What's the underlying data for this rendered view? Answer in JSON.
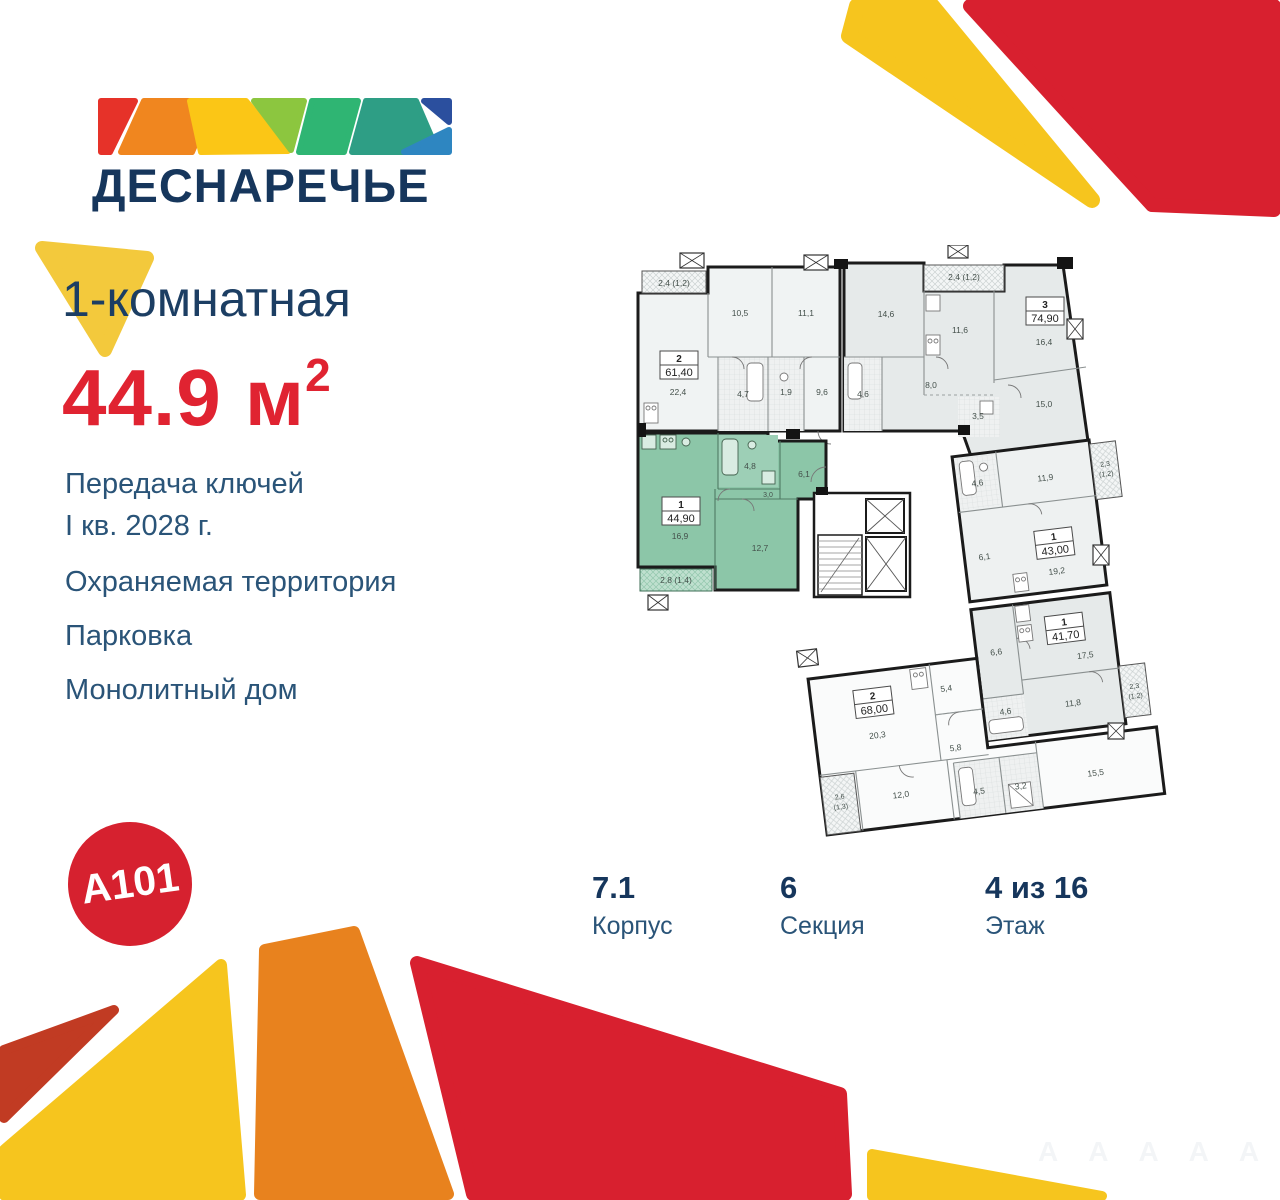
{
  "brand": {
    "logo_text": "ДЕСНАРЕЧЬЕ",
    "developer_logo": "A101"
  },
  "headline": {
    "rooms_type": "1-комнатная",
    "area_value": "44.9",
    "area_unit": " м",
    "area_sup": "2"
  },
  "features": {
    "keys_line1": "Передача ключей",
    "keys_line2": "I кв. 2028 г.",
    "security": "Охраняемая территория",
    "parking": "Парковка",
    "construction": "Монолитный дом"
  },
  "details": {
    "building_value": "7.1",
    "building_label": "Корпус",
    "section_value": "6",
    "section_label": "Секция",
    "floor_value": "4 из 16",
    "floor_label": "Этаж"
  },
  "colors": {
    "accent_red": "#E02331",
    "brand_navy": "#16365C",
    "selected_unit_green": "#8CC6A8",
    "decor_yellow": "#F6C51E",
    "decor_orange": "#E8821E",
    "decor_red": "#D8202F",
    "decor_brick": "#C13B23"
  },
  "floor_plan": {
    "selected_unit": {
      "type": "1",
      "area": "44,90",
      "balcony": "2,8 (1,4)",
      "rooms": {
        "living": "16,9",
        "bath": "4,8",
        "hall_small": "3,0",
        "hall": "6,1",
        "bedroom": "12,7"
      }
    },
    "unit_2_61": {
      "type": "2",
      "area": "61,40",
      "balcony": "2,4 (1,2)",
      "rooms": {
        "r1": "10,5",
        "r2": "11,1",
        "r3": "22,4",
        "r4": "4,7",
        "r5": "1,9",
        "r6": "9,6"
      }
    },
    "unit_3_74": {
      "type": "3",
      "area": "74,90",
      "balcony": "2,4 (1,2)",
      "rooms": {
        "r1": "14,6",
        "r2": "11,6",
        "r3": "16,4",
        "r4": "8,0",
        "r5": "4,6",
        "r6": "3,5",
        "r7": "15,0"
      }
    },
    "unit_1_43": {
      "type": "1",
      "area": "43,00",
      "balcony_line1": "2,3",
      "balcony_line2": "(1,2)",
      "rooms": {
        "r1": "4,6",
        "r2": "11,9",
        "r3": "6,1",
        "r4": "19,2"
      }
    },
    "unit_1_41": {
      "type": "1",
      "area": "41,70",
      "balcony_line1": "2,3",
      "balcony_line2": "(1,2)",
      "rooms": {
        "r1": "6,6",
        "r2": "17,5",
        "r3": "11,8",
        "r4": "4,6"
      }
    },
    "unit_2_68": {
      "type": "2",
      "area": "68,00",
      "balcony_line1": "2,6",
      "balcony_line2": "(1,3)",
      "rooms": {
        "r1": "5,4",
        "r2": "20,3",
        "r3": "5,8",
        "r4": "12,0",
        "r5": "4,5",
        "r6": "3,2",
        "r7": "15,5"
      }
    }
  }
}
